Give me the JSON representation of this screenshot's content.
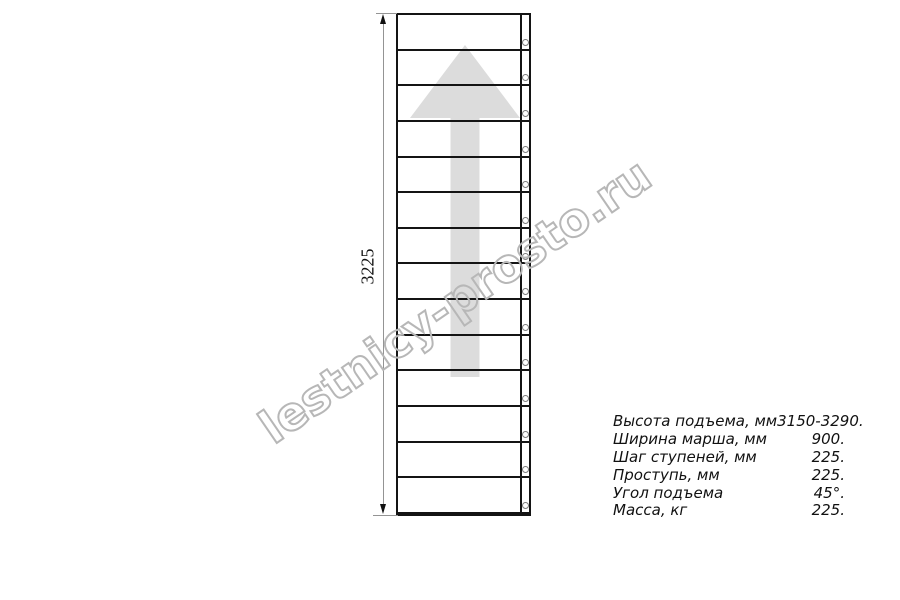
{
  "drawing": {
    "type": "straight-staircase-plan",
    "dimension_label": "3225",
    "step_count": 14,
    "watermark_text": "lestnicy-prosto.ru",
    "colors": {
      "line": "#141414",
      "dimension": "#949494",
      "arrow_fill": "#dcdcdc",
      "watermark_stroke": "#b7b7b7",
      "background": "#ffffff"
    }
  },
  "specs": {
    "rows": [
      {
        "label": "Высота подъема, мм",
        "value": "3150-3290."
      },
      {
        "label": "Ширина марша, мм",
        "value": "900."
      },
      {
        "label": "Шаг ступеней, мм",
        "value": "225."
      },
      {
        "label": "Проступь, мм",
        "value": "225."
      },
      {
        "label": "Угол подъема",
        "value": "45°."
      },
      {
        "label": "Масса, кг",
        "value": "225."
      }
    ]
  }
}
